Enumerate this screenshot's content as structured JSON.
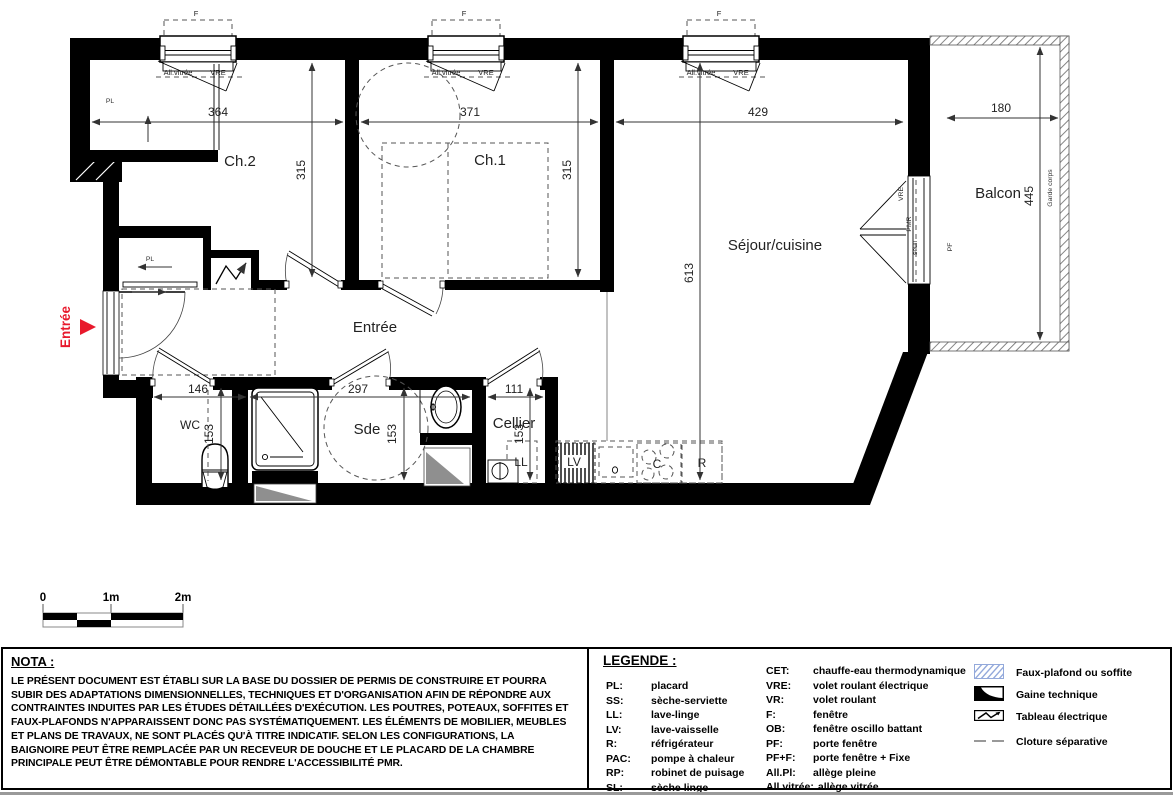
{
  "plan": {
    "rooms": {
      "ch2": "Ch.2",
      "ch1": "Ch.1",
      "sejour": "Séjour/cuisine",
      "balcon": "Balcon",
      "entree_hall": "Entrée",
      "wc": "WC",
      "sde": "Sde",
      "cellier": "Cellier"
    },
    "entry_marker": "Entrée",
    "dims": {
      "d364": "364",
      "d371": "371",
      "d429": "429",
      "d180": "180",
      "d315": "315",
      "d613": "613",
      "d445": "445",
      "d146": "146",
      "d297": "297",
      "d111": "111",
      "d153": "153"
    },
    "labels": {
      "f": "F",
      "all_vitree": "All.vitrée",
      "vre": "VRE",
      "pl": "PL",
      "pmr": "PMR",
      "seuil": "seuil",
      "pf": "PF",
      "garde_corps": "Garde corps",
      "ll": "LL",
      "lv": "LV",
      "r": "R",
      "c": "C",
      "o": "o"
    }
  },
  "scalebar": {
    "zero": "0",
    "one": "1m",
    "two": "2m"
  },
  "nota": {
    "title": "NOTA :",
    "body": "LE PRÉSENT DOCUMENT EST ÉTABLI SUR LA BASE DU DOSSIER DE PERMIS DE CONSTRUIRE ET POURRA SUBIR DES ADAPTATIONS DIMENSIONNELLES, TECHNIQUES ET D'ORGANISATION AFIN DE RÉPONDRE AUX CONTRAINTES INDUITES PAR LES ÉTUDES DÉTAILLÉES D'EXÉCUTION. LES POUTRES, POTEAUX, SOFFITES ET FAUX-PLAFONDS N'APPARAISSENT DONC PAS SYSTÉMATIQUEMENT. LES ÉLÉMENTS DE MOBILIER, MEUBLES ET PLANS DE TRAVAUX, NE SONT PLACÉS QU'À TITRE INDICATIF. SELON LES CONFIGURATIONS, LA BAIGNOIRE PEUT ÊTRE REMPLACÉE PAR UN RECEVEUR DE DOUCHE ET LE PLACARD DE LA CHAMBRE PRINCIPALE PEUT ÊTRE DÉMONTABLE POUR RENDRE L'ACCESSIBILITÉ PMR."
  },
  "legend": {
    "title": "LEGENDE :",
    "col1": [
      {
        "abbr": "PL:",
        "label": "placard"
      },
      {
        "abbr": "SS:",
        "label": "sèche-serviette"
      },
      {
        "abbr": "LL:",
        "label": "lave-linge"
      },
      {
        "abbr": "LV:",
        "label": "lave-vaisselle"
      },
      {
        "abbr": "R:",
        "label": "réfrigérateur"
      },
      {
        "abbr": "PAC:",
        "label": "pompe à chaleur"
      },
      {
        "abbr": "RP:",
        "label": "robinet de puisage"
      },
      {
        "abbr": "SL:",
        "label": "sèche linge"
      }
    ],
    "col2": [
      {
        "abbr": "CET:",
        "label": "chauffe-eau thermodynamique"
      },
      {
        "abbr": "VRE:",
        "label": "volet roulant électrique"
      },
      {
        "abbr": "VR:",
        "label": "volet roulant"
      },
      {
        "abbr": "F:",
        "label": "fenêtre"
      },
      {
        "abbr": "OB:",
        "label": "fenêtre oscillo battant"
      },
      {
        "abbr": "PF:",
        "label": "porte fenêtre"
      },
      {
        "abbr": "PF+F:",
        "label": "porte fenêtre + Fixe"
      },
      {
        "abbr": "All.Pl:",
        "label": "allège pleine"
      },
      {
        "abbr": "All.vitrée:",
        "label": "allège vitrée"
      }
    ],
    "symbols": [
      {
        "label": "Faux-plafond ou soffite"
      },
      {
        "label": "Gaine technique"
      },
      {
        "label": "Tableau électrique"
      },
      {
        "label": "Cloture séparative"
      }
    ]
  },
  "colors": {
    "entry_red": "#e8192c",
    "hatch_blue": "#93a9db",
    "wall_black": "#000000"
  }
}
